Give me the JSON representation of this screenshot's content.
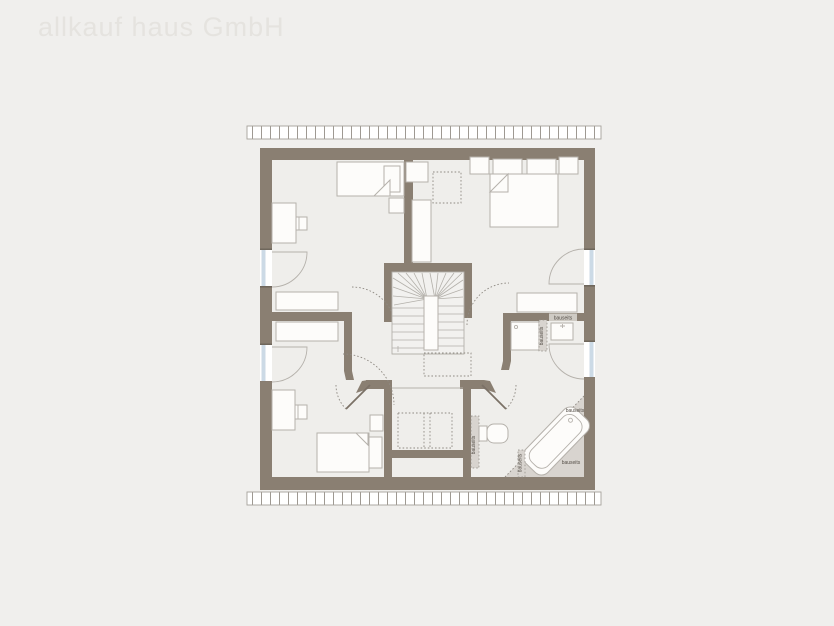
{
  "watermark": "allkauf haus GmbH",
  "labels": {
    "bauseits": "bauseits"
  },
  "colors": {
    "background": "#f0efed",
    "floor": "#efeeeb",
    "wall": "#8a7f72",
    "furnline": "#b5b1ab",
    "glass": "#ccdae6",
    "fixture": "#d8d4cf",
    "watermark": "#e5e3df"
  },
  "plan": {
    "type": "floor-plan",
    "features": [
      "single-bed",
      "double-bed",
      "desk",
      "chair",
      "nightstand",
      "wardrobe",
      "sideboard",
      "winder-stairs",
      "bathtub",
      "toilet",
      "washbasin",
      "shower",
      "window",
      "door",
      "roof-eaves",
      "chimney"
    ],
    "onsite_note_occurrences": 6
  }
}
